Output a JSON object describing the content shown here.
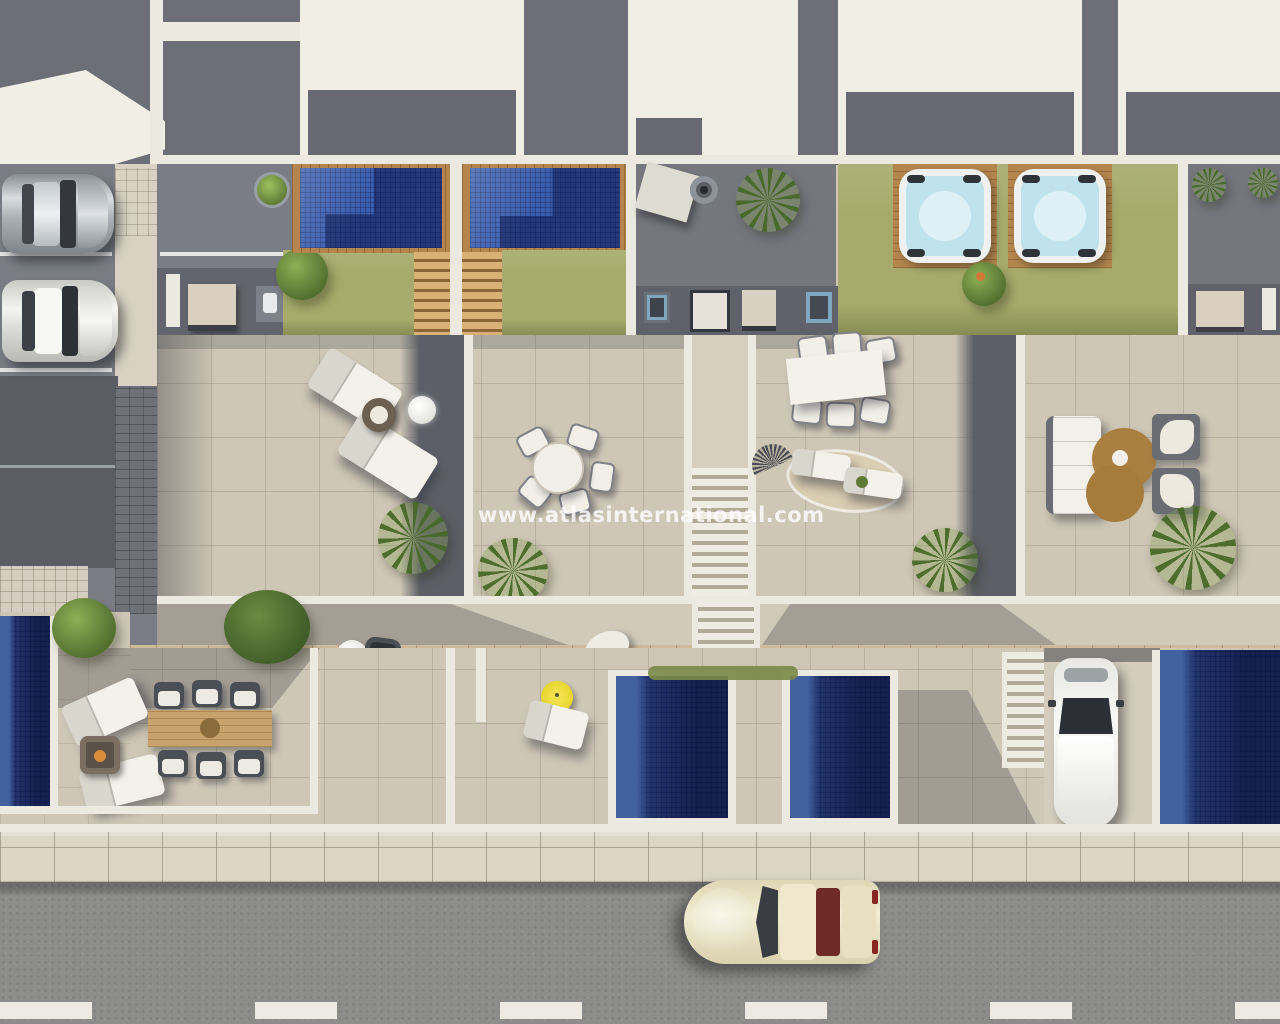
{
  "watermark": {
    "text": "www.atlasinternational.com"
  },
  "scene": {
    "type": "architectural-aerial-render",
    "objects": [
      "flat-roofs",
      "parking-lot",
      "silver-car",
      "white-car",
      "pedestrian-walkway",
      "plunge-pool-1",
      "plunge-pool-2",
      "private-lawns",
      "roof-patio",
      "shade-sail",
      "fire-pit",
      "palm-trees",
      "hot-tub-1",
      "hot-tub-2",
      "outdoor-kitchen-units",
      "sun-loungers",
      "round-dining-set",
      "rectangular-dining-table",
      "lounge-sofa-set",
      "figure-eight-rug",
      "wood-boardwalk",
      "staircases",
      "lower-pools",
      "yellow-parasol",
      "hanging-chair",
      "wooden-dining-table",
      "fire-pit-table",
      "driveway",
      "parked-car",
      "tiled-sidewalk",
      "asphalt-road",
      "classic-car",
      "lane-markings"
    ]
  },
  "palette": {
    "roof_white": "#f1eee6",
    "roof_gray": "#6c6f77",
    "asphalt": "#7a7d85",
    "terrace_tile": "#cfc7b6",
    "grass": "#a6ab6b",
    "pool_blue": "#3a5eae",
    "pool_dark": "#1f3170",
    "hot_tub_water": "#bfe2ec",
    "wood_deck": "#b5854e",
    "road": "#8c8c8a",
    "sidewalk": "#ddd6c6",
    "parasol_yellow": "#e6d429",
    "watermark_color": "rgba(255,255,255,0.8)"
  }
}
